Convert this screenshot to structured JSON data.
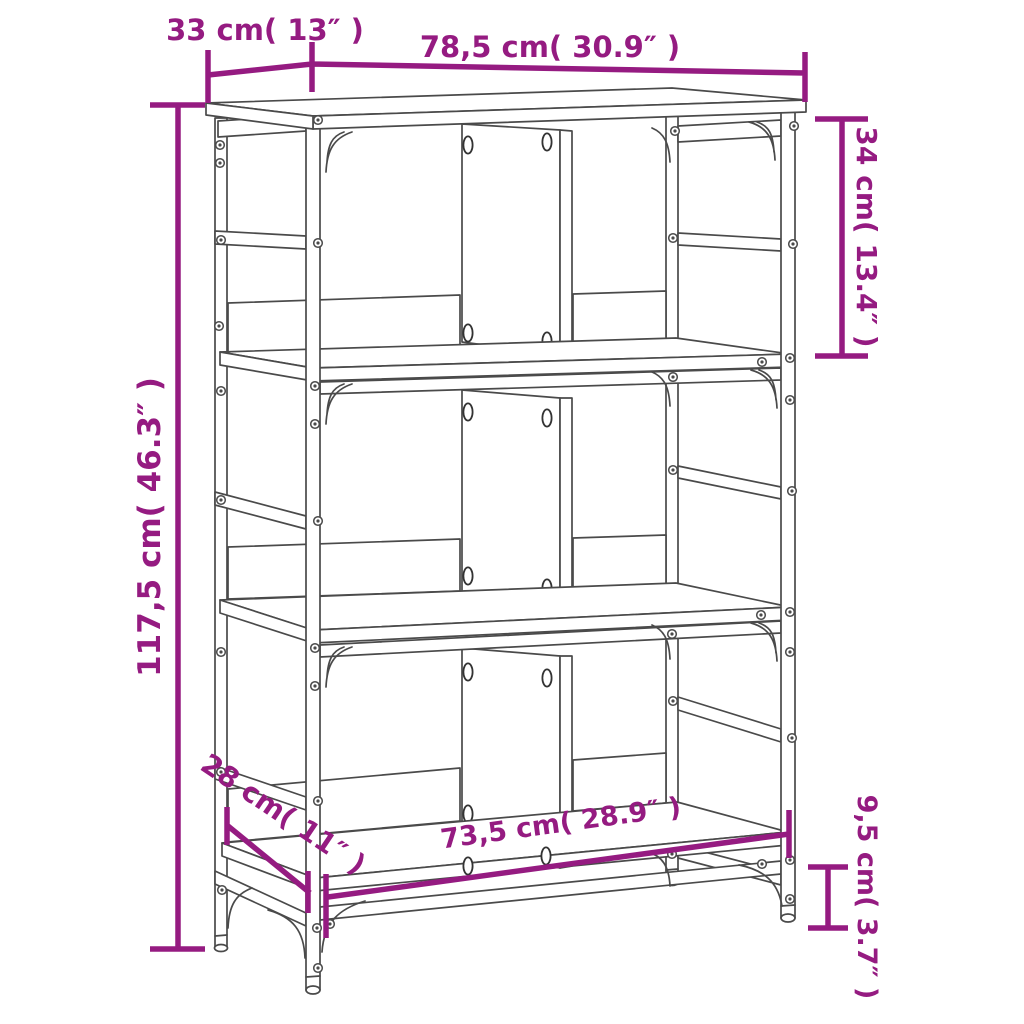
{
  "diagram": {
    "type": "furniture-dimension-diagram",
    "product": "3-tier bookshelf with metal frame",
    "accent_color": "#951B81",
    "line_color": "#4a4a4a",
    "background": "#ffffff",
    "labels": {
      "top_depth": "33 cm( 13″ )",
      "top_width": "78,5 cm( 30.9″ )",
      "upper_section_height": "34 cm( 13.4″ )",
      "total_height": "117,5 cm( 46.3″ )",
      "bottom_shelf_depth": "28 cm( 11″ )",
      "bottom_shelf_width": "73,5 cm( 28.9″ )",
      "foot_height": "9,5 cm( 3.7″ )"
    }
  }
}
